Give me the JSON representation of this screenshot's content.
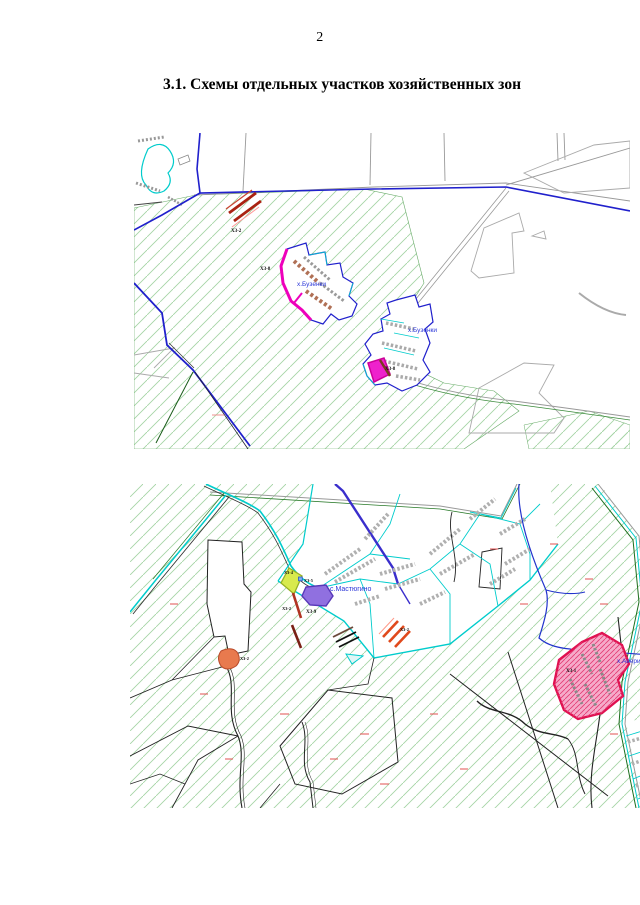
{
  "page": {
    "number": "2",
    "title": "3.1. Схемы отдельных участков хозяйственных зон"
  },
  "maps": [
    {
      "settlements": [
        {
          "label": "х.Бузенки"
        },
        {
          "label": "х.Бузенки"
        }
      ],
      "zones": [
        {
          "label": "ХЗ-2",
          "color": "#aa2211"
        },
        {
          "label": "ХЗ-8",
          "color": "#ee00bb"
        },
        {
          "label": "ХЗ-8",
          "color": "#ee22cc"
        }
      ]
    },
    {
      "settlements": [
        {
          "label": "с.Мастюгино"
        },
        {
          "label": "х.Аверино"
        }
      ],
      "zones": [
        {
          "label": "ХЗ-4",
          "color": "#d8ea4d"
        },
        {
          "label": "ХЗ-5",
          "color": "#7ab0f0"
        },
        {
          "label": "ХЗ-9",
          "color": "#9070e0"
        },
        {
          "label": "ХЗ-2",
          "color": "#b03322"
        },
        {
          "label": "ХЗ-2",
          "color": "#e0491c"
        },
        {
          "label": "ХЗ-2",
          "color": "#e87a4e"
        },
        {
          "label": "ХЗ-1",
          "color": "#e01050"
        }
      ]
    }
  ],
  "colors": {
    "hatch_green": "#9ccc9c",
    "boundary_blue": "#2020cc",
    "water_cyan": "#00cccc",
    "road_gray": "#999999",
    "settlement_label_blue": "#2a35d8",
    "annotation_red": "#e05050",
    "zone1_fill_pink": "#f6aac9"
  }
}
